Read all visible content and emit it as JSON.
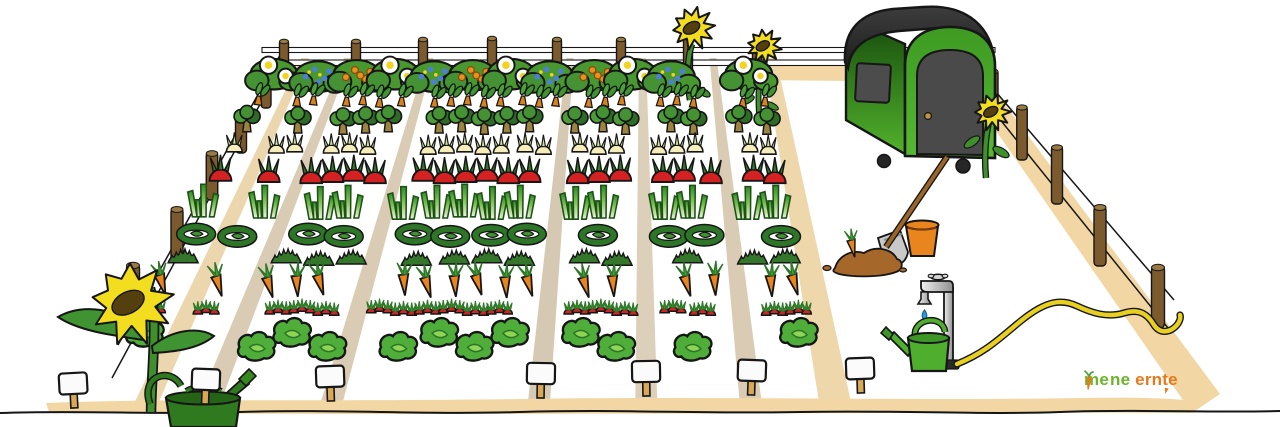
{
  "canvas": {
    "width": 1280,
    "height": 427,
    "background": "#ffffff"
  },
  "logo": {
    "text": "meine ernte",
    "me": "me",
    "ne": "ne",
    "ern": "ern",
    "t": "t",
    "e": "e",
    "green": "#6cb52c",
    "orange": "#e8791a"
  },
  "garden": {
    "back": {
      "y": 60,
      "x1": 270,
      "x2": 770
    },
    "front": {
      "y": 393,
      "x1": 95,
      "x2": 835
    },
    "rows": [
      {
        "crop": "flower-hedge",
        "label": "flowering hedge row",
        "icon": "bush",
        "y": 97,
        "scale": 1.8,
        "count": 13
      },
      {
        "crop": "chard-seedlings",
        "label": "chard seedling row",
        "icon": "chard",
        "y": 106,
        "scale": 1.25,
        "count": 30
      },
      {
        "crop": "broccoli",
        "label": "broccoli row",
        "icon": "broccoli",
        "y": 133,
        "scale": 1.35,
        "count": 23
      },
      {
        "crop": "onions",
        "label": "onion row",
        "icon": "onion",
        "y": 153,
        "scale": 1.3,
        "count": 29
      },
      {
        "crop": "beetroot",
        "label": "beetroot row",
        "icon": "beet",
        "y": 182,
        "scale": 1.45,
        "count": 26
      },
      {
        "crop": "leeks",
        "label": "leek row",
        "icon": "leek",
        "y": 218,
        "scale": 1.55,
        "count": 21
      },
      {
        "crop": "spinach",
        "label": "spinach row",
        "icon": "spinach",
        "y": 242,
        "scale": 1.5,
        "count": 17
      },
      {
        "crop": "herbs",
        "label": "herb row",
        "icon": "herb",
        "y": 264,
        "scale": 1.25,
        "count": 19
      },
      {
        "crop": "carrots",
        "label": "carrot row",
        "icon": "carrot",
        "y": 295,
        "scale": 1.5,
        "count": 25
      },
      {
        "crop": "radishes",
        "label": "radish row",
        "icon": "radish",
        "y": 314,
        "scale": 1.5,
        "count": 27
      },
      {
        "crop": "lettuce",
        "label": "lettuce row",
        "icon": "lettuce",
        "y": 340,
        "scale": 1.7,
        "count": 19,
        "stagger": 14
      }
    ],
    "paths": [
      {
        "rel": 0.07,
        "tone": "#ecd6ae",
        "wb": 4,
        "wf": 12
      },
      {
        "rel": 0.155,
        "tone": "#d9cbb4",
        "wb": 3.5,
        "wf": 11
      },
      {
        "rel": 0.32,
        "tone": "#d9cbb4",
        "wb": 3.5,
        "wf": 11
      },
      {
        "rel": 0.6,
        "tone": "#d6c9b4",
        "wb": 3.5,
        "wf": 11
      },
      {
        "rel": 0.745,
        "tone": "#ddd0ba",
        "wb": 3.5,
        "wf": 11
      },
      {
        "rel": 0.886,
        "tone": "#d9cbb4",
        "wb": 3.5,
        "wf": 11
      },
      {
        "rel": 1.0,
        "tone": "#eed7ab",
        "wb": 6,
        "wf": 16
      }
    ],
    "signs": [
      [
        73,
        381
      ],
      [
        206,
        377
      ],
      [
        330,
        374
      ],
      [
        541,
        371
      ],
      [
        646,
        369
      ],
      [
        752,
        368
      ],
      [
        860,
        366
      ]
    ]
  },
  "objects": [
    {
      "name": "caravan",
      "desc": "green tool caravan with dark rounded roof, door, window and wheels"
    },
    {
      "name": "sunflowers-back",
      "count": 2
    },
    {
      "name": "sunflower-caravan",
      "count": 1
    },
    {
      "name": "sunflower-front-left",
      "count": 1
    },
    {
      "name": "spade-in-soil"
    },
    {
      "name": "harvested-carrot"
    },
    {
      "name": "soil-mound"
    },
    {
      "name": "bucket"
    },
    {
      "name": "water-tap-with-drop"
    },
    {
      "name": "garden-hose"
    },
    {
      "name": "watering-can-right"
    },
    {
      "name": "watering-can-left"
    },
    {
      "name": "bed-signs",
      "count": 7,
      "blank": true
    },
    {
      "name": "wire-fence-with-wood-posts"
    }
  ],
  "colors": {
    "bush_green": "#49982f",
    "bush_green_dark": "#449234",
    "flower_white": "#ffffff",
    "flower_yellow": "#f2d41e",
    "flower_blue": "#4d7fd6",
    "berry_orange": "#e8921e",
    "chard_stem": "#d8821e",
    "broccoli_light": "#4c9c3a",
    "broccoli_dark": "#2e6b26",
    "trunk": "#9c8440",
    "onion_cream": "#f5edba",
    "onion_leaf": "#cfe09a",
    "beet_red": "#d42222",
    "beet_leaf": "#2e7a28",
    "leek_dark": "#2f8a28",
    "leek_light": "#eff3da",
    "spinach_ring": "#2d7527",
    "herb_green": "#35772a",
    "carrot_orange": "#e8851c",
    "carrot_leaf": "#4aa338",
    "radish_red": "#cc2525",
    "lettuce_green": "#4fae3a",
    "lettuce_inner": "#8ed455",
    "path_tan": "#f2d7a4",
    "post_brown": "#7b5a2d",
    "post_top": "#9a7a42",
    "sign_white": "#fbfbfb",
    "sign_wood": "#d8a857",
    "caravan_green": "#52b22c",
    "caravan_roof": "#1c1c1c",
    "door_gray": "#4a4a4a",
    "knob_brass": "#bd9440",
    "bucket_orange": "#e8851c",
    "soil_brown": "#a5672a",
    "spade_metal": "#c9c9c9",
    "handle_wood": "#9a6526",
    "tap_drop_blue": "#2e9ad8",
    "hose_yellow": "#e8d020",
    "can_bright": "#4fae2e",
    "can_dark": "#2f7a1f",
    "petal_yellow": "#f2dd1f",
    "flower_center": "#54400f",
    "stem_green": "#3f8f2c",
    "outline": "#161616"
  }
}
